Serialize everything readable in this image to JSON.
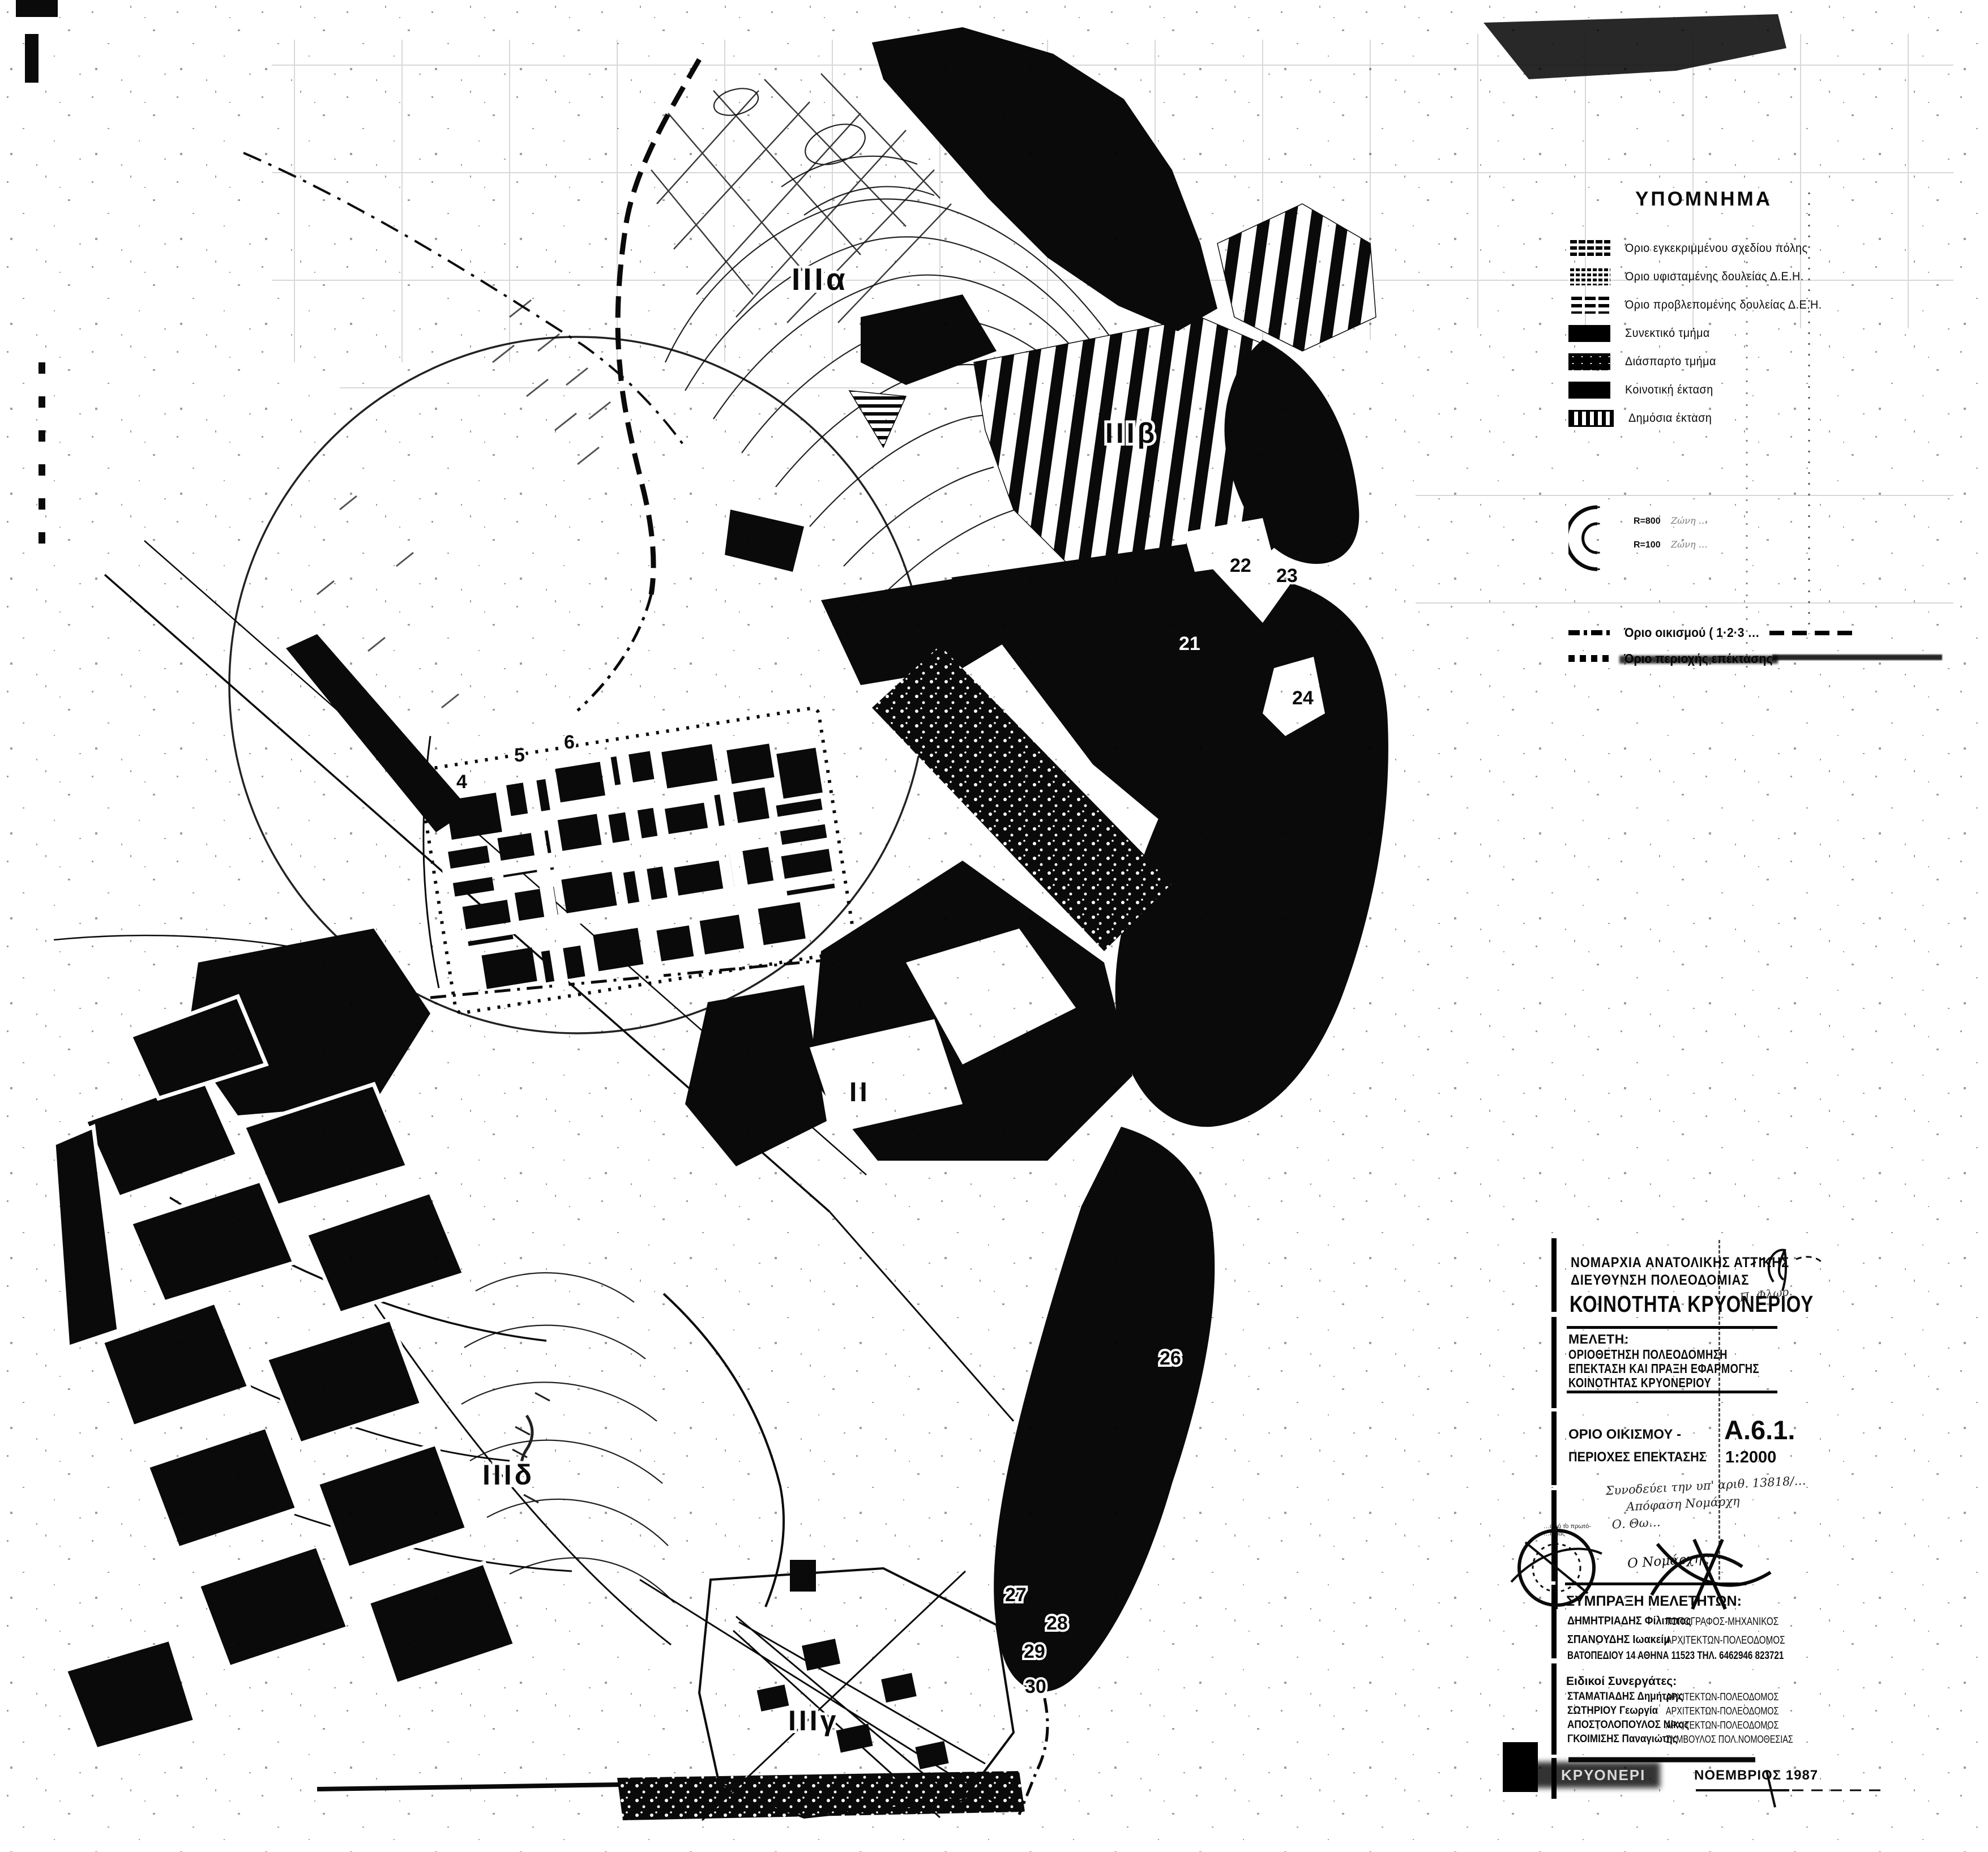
{
  "page": {
    "paper_color": "#ffffff",
    "ink_color": "#0a0a0a"
  },
  "legend": {
    "title": "ΥΠΟΜΝΗΜΑ",
    "items": [
      {
        "label": "Όριο εγκεκριμμένου σχεδίου πόλης"
      },
      {
        "label": "Όριο υφισταμένης δουλείας Δ.Ε.Η."
      },
      {
        "label": "Όριο προβλεπομένης δουλείας Δ.Ε.Η."
      },
      {
        "label": "Συνεκτικό τμήμα"
      },
      {
        "label": "Διάσπαρτο τμήμα"
      },
      {
        "label": "Κοινοτική έκταση"
      },
      {
        "label": "Δημόσια έκταση"
      }
    ],
    "radius_entries": [
      {
        "radius": "R=800",
        "zone": "Ζώνη …"
      },
      {
        "radius": "R=100",
        "zone": "Ζώνη …"
      }
    ],
    "boundary_entries": [
      {
        "label": "Όριο οικισμού ( 1·2·3 …"
      },
      {
        "label": "Όριο περιοχής επέκτασης"
      }
    ]
  },
  "map": {
    "region_labels": [
      "IIIα",
      "IIIβ",
      "II",
      "IIIδ",
      "IIIγ"
    ],
    "point_numbers": [
      "4",
      "5",
      "6",
      "21",
      "22",
      "23",
      "24",
      "26",
      "27",
      "28",
      "29",
      "30"
    ]
  },
  "title_block": {
    "agency_line1": "ΝΟΜΑΡΧΙΑ ΑΝΑΤΟΛΙΚΗΣ ΑΤΤΙΚΗΣ",
    "agency_line2": "ΔΙΕΥΘΥΝΣΗ ΠΟΛΕΟΔΟΜΙΑΣ",
    "community": "ΚΟΙΝΟΤΗΤΑ ΚΡΥΟΝΕΡΙΟΥ",
    "signature_top": "Π. Φλωρ.",
    "study_heading": "ΜΕΛΕΤΗ:",
    "study_line1": "ΟΡΙΟΘΕΤΗΣΗ  ΠΟΛΕΟΔΟΜΗΣΗ",
    "study_line2": "ΕΠΕΚΤΑΣΗ ΚΑΙ ΠΡΑΞΗ ΕΦΑΡΜΟΓΗΣ",
    "study_line3": "ΚΟΙΝΟΤΗΤΑΣ ΚΡΥΟΝΕΡΙΟΥ",
    "sheet_title_line1": "ΟΡΙΟ ΟΙΚΙΣΜΟΥ -",
    "sheet_title_line2": "ΠΕΡΙΟΧΕΣ ΕΠΕΚΤΑΣΗΣ",
    "sheet_code": "Α.6.1.",
    "scale": "1:2000",
    "handnote_line1": "Συνοδεύει την υπ' αριθ. 13818/…",
    "handnote_line2": "Απόφαση Νομάρχη",
    "handnote_line3": "Ο. Θω…",
    "stamp_text_line1": "…από το πρωτό-",
    "stamp_text_line2": "…ησίας",
    "nomarch_label": "Ο Νομάρχης",
    "team_heading": "ΣΥΜΠΡΑΞΗ ΜΕΛΕΤΗΤΩΝ:",
    "consultants": [
      {
        "name": "ΔΗΜΗΤΡΙΑΔΗΣ Φίλιππος",
        "role": "ΤΟΠΟΓΡΑΦΟΣ-ΜΗΧΑΝΙΚΟΣ"
      },
      {
        "name": "ΣΠΑΝΟΥΔΗΣ Ιωακείμ",
        "role": "ΑΡΧΙΤΕΚΤΩΝ-ΠΟΛΕΟΔΟΜΟΣ"
      }
    ],
    "address": "ΒΑΤΟΠΕΔΙΟΥ 14   ΑΘΗΝΑ   11523    ΤΗΛ. 6462946  823721",
    "associates_heading": "Ειδικοί Συνεργάτες:",
    "associates": [
      {
        "name": "ΣΤΑΜΑΤΙΑΔΗΣ Δημήτρης",
        "role": "ΑΡΧΙΤΕΚΤΩΝ-ΠΟΛΕΟΔΟΜΟΣ"
      },
      {
        "name": "ΣΩΤΗΡΙΟΥ Γεωργία",
        "role": "ΑΡΧΙΤΕΚΤΩΝ-ΠΟΛΕΟΔΟΜΟΣ"
      },
      {
        "name": "ΑΠΟΣΤΟΛΟΠΟΥΛΟΣ Νίκος",
        "role": "ΑΡΧΙΤΕΚΤΩΝ-ΠΟΛΕΟΔΟΜΟΣ"
      },
      {
        "name": "ΓΚΟΙΜΙΣΗΣ Παναγιώτης",
        "role": "ΣΥΜΒΟΥΛΟΣ ΠΟΛ.ΝΟΜΟΘΕΣΙΑΣ"
      }
    ],
    "footer_location": "ΚΡΥΟΝΕΡΙ",
    "footer_date": "ΝΟΕΜΒΡΙΟΣ 1987"
  }
}
